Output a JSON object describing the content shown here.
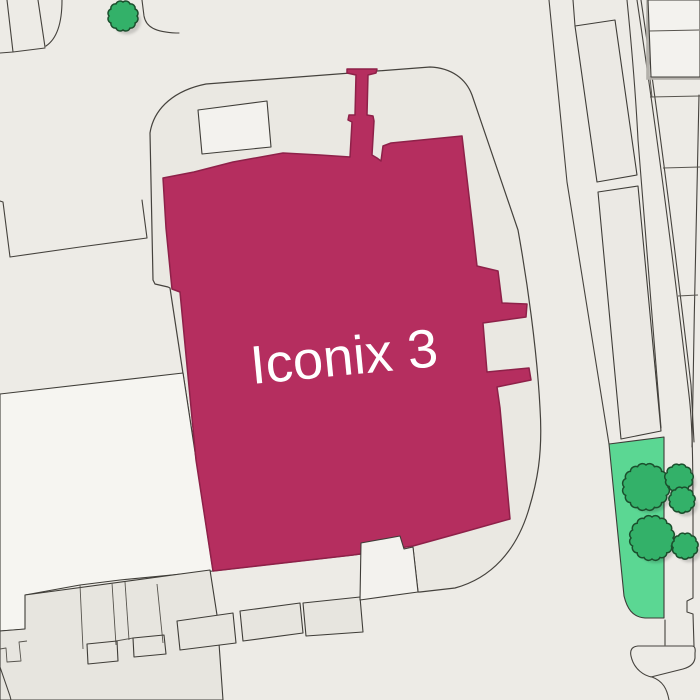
{
  "map": {
    "label": "Iconix 3",
    "colors": {
      "background": "#edebe6",
      "parcel_fill": "#eae8e2",
      "block_fill": "#e7e5df",
      "light_fill": "#f6f5f1",
      "white_fill": "#f3f2ee",
      "strip_fill": "#ebe9e4",
      "highlight": "#b52e5f",
      "highlight_stroke": "#8e2149",
      "green": "#5bd793",
      "green_stroke": "#3d3b37",
      "tree_fill": "#33b169",
      "tree_stroke": "#1b4f2d",
      "label_text": "#ffffff"
    },
    "trees": [
      {
        "cx": 123,
        "cy": 16,
        "r": 14
      },
      {
        "cx": 646,
        "cy": 487,
        "r": 22
      },
      {
        "cx": 679,
        "cy": 478,
        "r": 13
      },
      {
        "cx": 682,
        "cy": 500,
        "r": 12
      },
      {
        "cx": 652,
        "cy": 538,
        "r": 21
      },
      {
        "cx": 685,
        "cy": 546,
        "r": 12
      }
    ]
  }
}
